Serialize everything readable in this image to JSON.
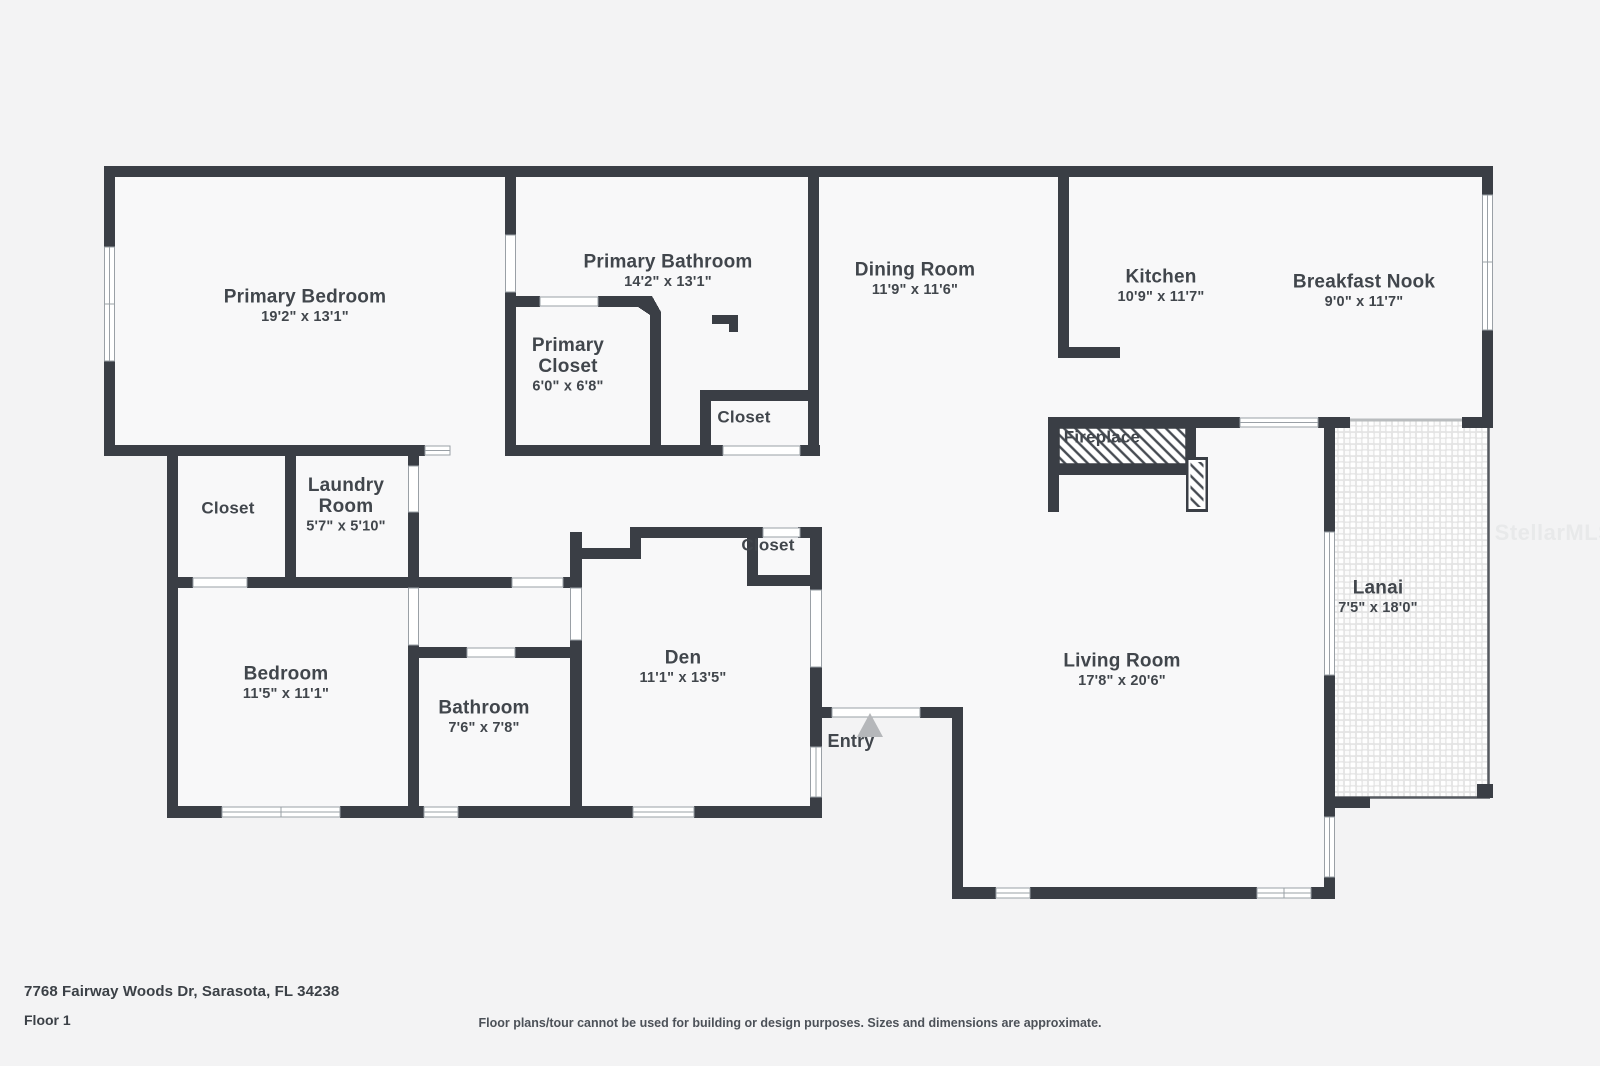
{
  "meta": {
    "watermark": "StellarMLS",
    "plan_type": "floor-plan"
  },
  "palette": {
    "background": "#f3f3f4",
    "room_fill": "#f8f8f9",
    "wall": "#3a3e45",
    "label_text": "#41464c",
    "window_frame": "#9aa0a6",
    "entry_arrow": "#b5b7ba",
    "watermark_color": "#e8e9ea"
  },
  "footer": {
    "address": "7768 Fairway Woods Dr, Sarasota, FL 34238",
    "floor": "Floor 1",
    "disclaimer": "Floor plans/tour cannot be used for building or design purposes. Sizes and dimensions are approximate."
  },
  "rooms": [
    {
      "id": "primary-bedroom",
      "name": "Primary Bedroom",
      "dims": "19'2\" x 13'1\"",
      "x": 305,
      "y": 307,
      "size": "lg"
    },
    {
      "id": "primary-bathroom",
      "name": "Primary Bathroom",
      "dims": "14'2\" x 13'1\"",
      "x": 668,
      "y": 272,
      "size": "lg"
    },
    {
      "id": "primary-closet",
      "name": "Primary Closet",
      "name_lines": [
        "Primary",
        "Closet"
      ],
      "dims": "6'0\" x 6'8\"",
      "x": 568,
      "y": 366,
      "size": "lg"
    },
    {
      "id": "closet-primary-bath",
      "name": "Closet",
      "x": 744,
      "y": 417,
      "size": "sm"
    },
    {
      "id": "dining-room",
      "name": "Dining Room",
      "dims": "11'9\" x 11'6\"",
      "x": 915,
      "y": 280,
      "size": "lg"
    },
    {
      "id": "kitchen",
      "name": "Kitchen",
      "dims": "10'9\" x 11'7\"",
      "x": 1161,
      "y": 287,
      "size": "lg"
    },
    {
      "id": "breakfast-nook",
      "name": "Breakfast Nook",
      "dims": "9'0\" x 11'7\"",
      "x": 1364,
      "y": 292,
      "size": "lg"
    },
    {
      "id": "fireplace",
      "name": "Fireplace",
      "x": 1102,
      "y": 437,
      "size": "sm"
    },
    {
      "id": "closet-hall",
      "name": "Closet",
      "x": 228,
      "y": 508,
      "size": "sm"
    },
    {
      "id": "laundry-room",
      "name": "Laundry Room",
      "name_lines": [
        "Laundry",
        "Room"
      ],
      "dims": "5'7\" x 5'10\"",
      "x": 346,
      "y": 506,
      "size": "lg"
    },
    {
      "id": "bedroom",
      "name": "Bedroom",
      "dims": "11'5\" x 11'1\"",
      "x": 286,
      "y": 684,
      "size": "lg"
    },
    {
      "id": "bathroom",
      "name": "Bathroom",
      "dims": "7'6\" x 7'8\"",
      "x": 484,
      "y": 718,
      "size": "lg"
    },
    {
      "id": "den",
      "name": "Den",
      "dims": "11'1\" x 13'5\"",
      "x": 683,
      "y": 668,
      "size": "lg"
    },
    {
      "id": "closet-den",
      "name": "Closet",
      "x": 768,
      "y": 545,
      "size": "sm"
    },
    {
      "id": "entry",
      "name": "Entry",
      "x": 851,
      "y": 741,
      "size": "md"
    },
    {
      "id": "living-room",
      "name": "Living Room",
      "dims": "17'8\" x 20'6\"",
      "x": 1122,
      "y": 671,
      "size": "lg"
    },
    {
      "id": "lanai",
      "name": "Lanai",
      "dims": "7'5\" x 18'0\"",
      "x": 1378,
      "y": 598,
      "size": "lg"
    }
  ]
}
